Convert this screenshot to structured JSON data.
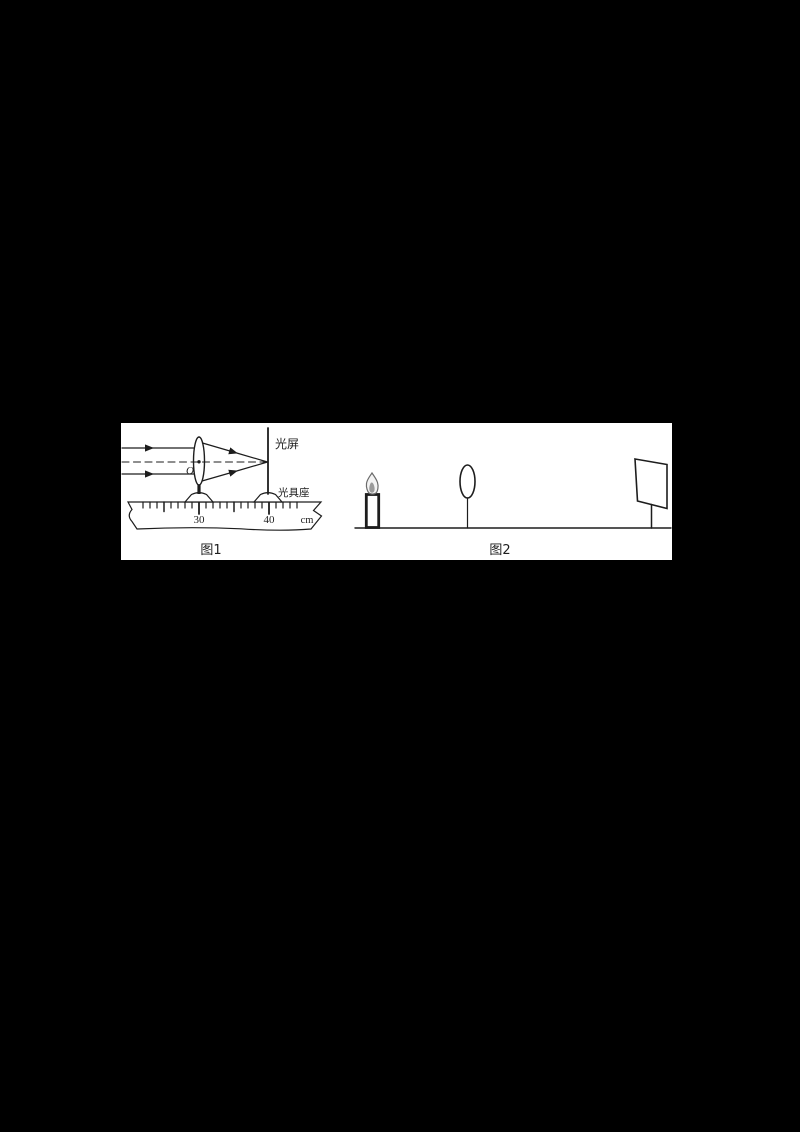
{
  "page": {
    "background_color": "#000000",
    "panel_color": "#ffffff",
    "line_color": "#1d1d1d"
  },
  "figure1": {
    "caption": "图1",
    "screen_label": "光屏",
    "bench_label": "光具座",
    "lens_center_label": "O",
    "ruler": {
      "mark30": "30",
      "mark40": "40",
      "unit": "cm"
    }
  },
  "figure2": {
    "caption": "图2"
  }
}
